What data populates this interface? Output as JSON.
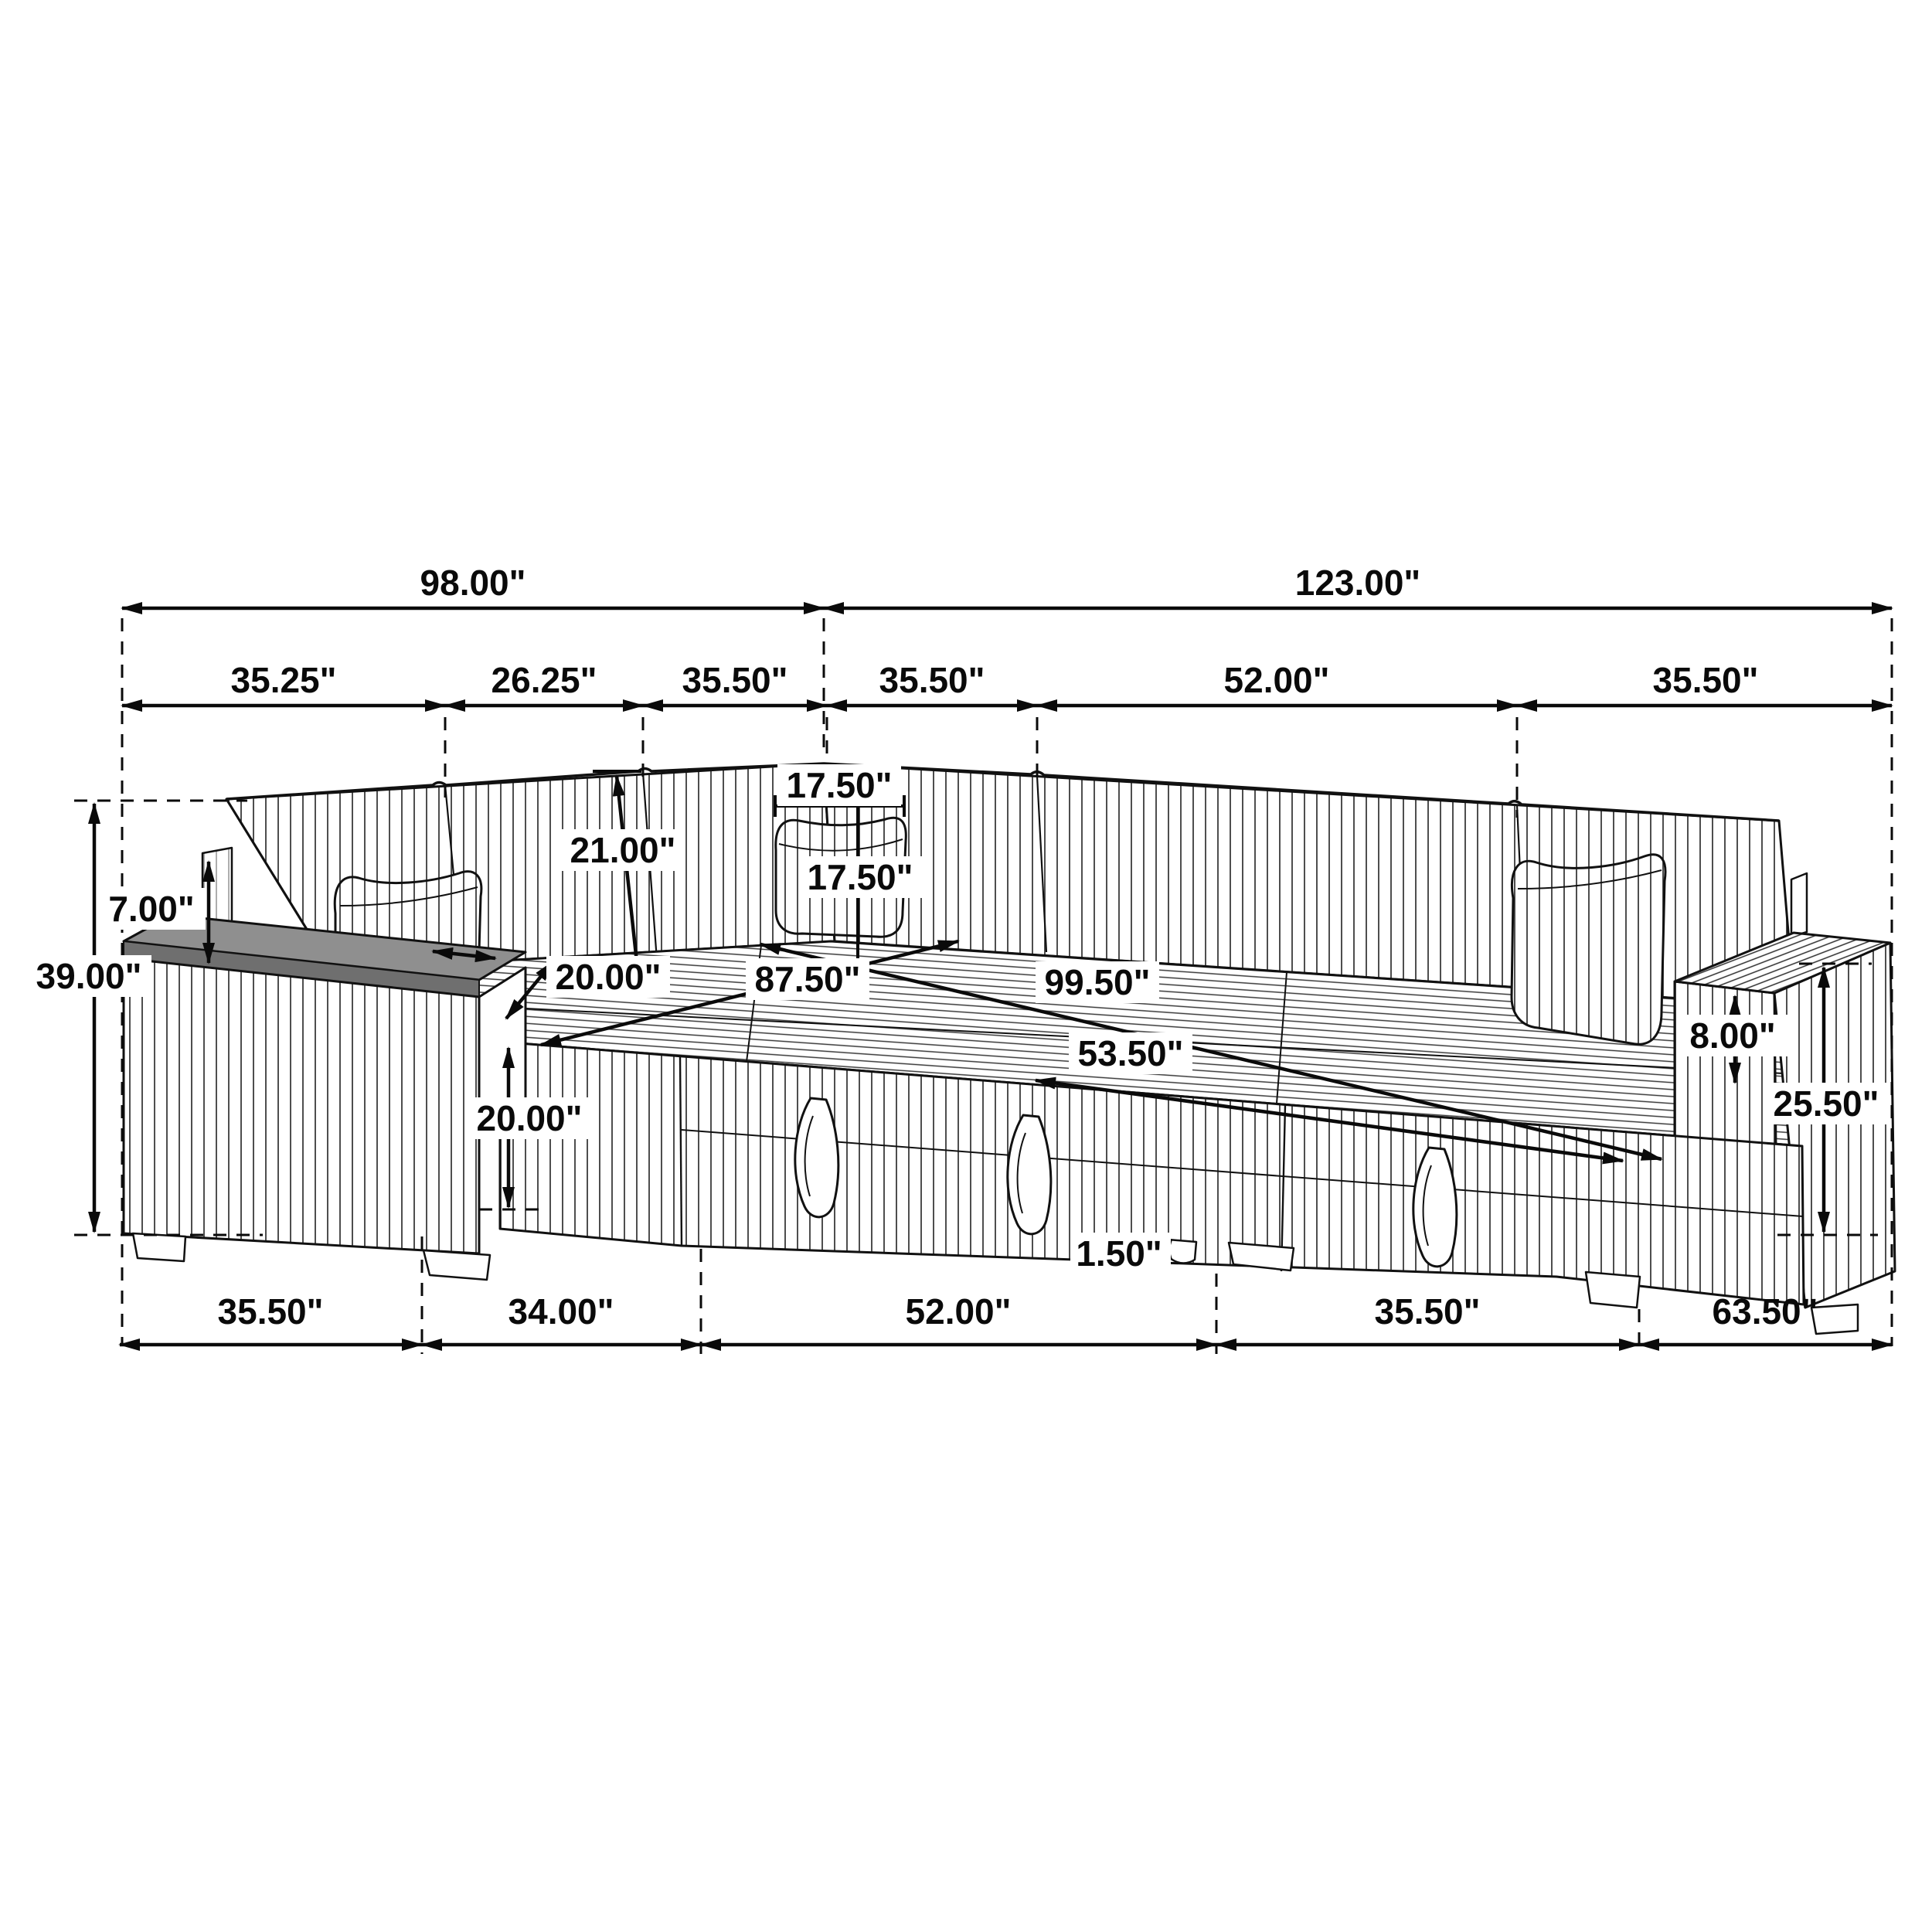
{
  "diagram": {
    "type": "furniture-dimension-drawing",
    "subject": "U-shaped sectional sleeper sofa with pull-out bed, storage arm consoles and accent pillows",
    "unit": "inches",
    "line_color": "#0a0a0a",
    "console_gray": "#8f8f8f",
    "dimensions": {
      "top": [
        "98.00\"",
        "123.00\""
      ],
      "upper": [
        "35.25\"",
        "26.25\"",
        "35.50\"",
        "35.50\"",
        "52.00\"",
        "35.50\""
      ],
      "bottom": [
        "35.50\"",
        "34.00\"",
        "52.00\"",
        "35.50\"",
        "63.50\""
      ],
      "heights": {
        "overall": "39.00\"",
        "back_above_arm": "7.00\"",
        "back_cushion": "21.00\"",
        "front_seat": "20.00\"",
        "arm_height": "25.50\"",
        "seat_to_arm_top": "8.00\"",
        "leg": "1.50\""
      },
      "surfaces": {
        "seat_depth": "20.00\"",
        "bed_depth": "87.50\"",
        "bed_length": "99.50\"",
        "bed_width": "53.50\"",
        "pillow_width": "17.50\"",
        "pillow_height": "17.50\""
      }
    }
  }
}
